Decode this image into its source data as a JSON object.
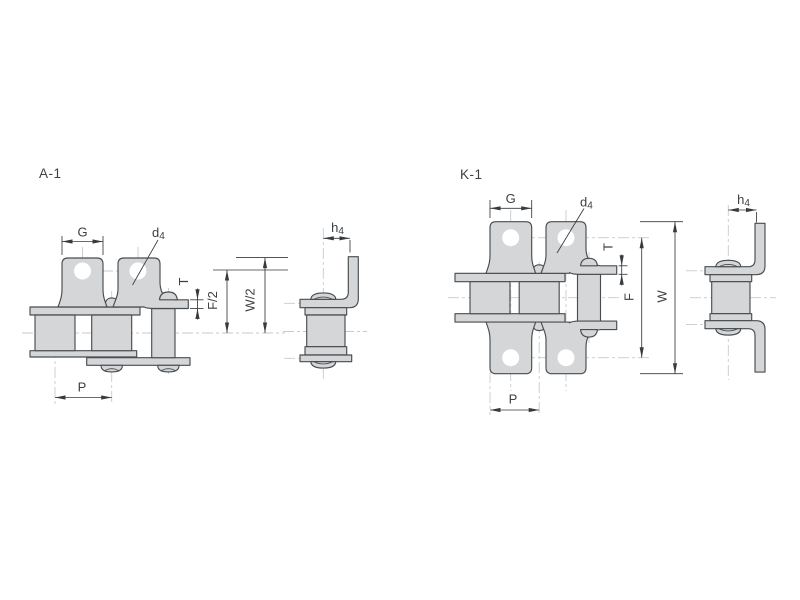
{
  "colors": {
    "bg": "#ffffff",
    "part_fill": "#d4d6d8",
    "part_stroke": "#494d50",
    "hole_fill": "#ffffff",
    "dim": "#373b3e",
    "text": "#3c4043",
    "centerline": "#c7cacc"
  },
  "a1": {
    "title": "A-1",
    "dim_g": "G",
    "dim_d4_base": "d",
    "dim_d4_sub": "4",
    "dim_t": "T",
    "dim_f_half": "F/2",
    "dim_w_half": "W/2",
    "dim_p": "P",
    "dim_h4_base": "h",
    "dim_h4_sub": "4"
  },
  "k1": {
    "title": "K-1",
    "dim_g": "G",
    "dim_d4_base": "d",
    "dim_d4_sub": "4",
    "dim_t": "T",
    "dim_f": "F",
    "dim_w": "W",
    "dim_p": "P",
    "dim_h4_base": "h",
    "dim_h4_sub": "4"
  }
}
